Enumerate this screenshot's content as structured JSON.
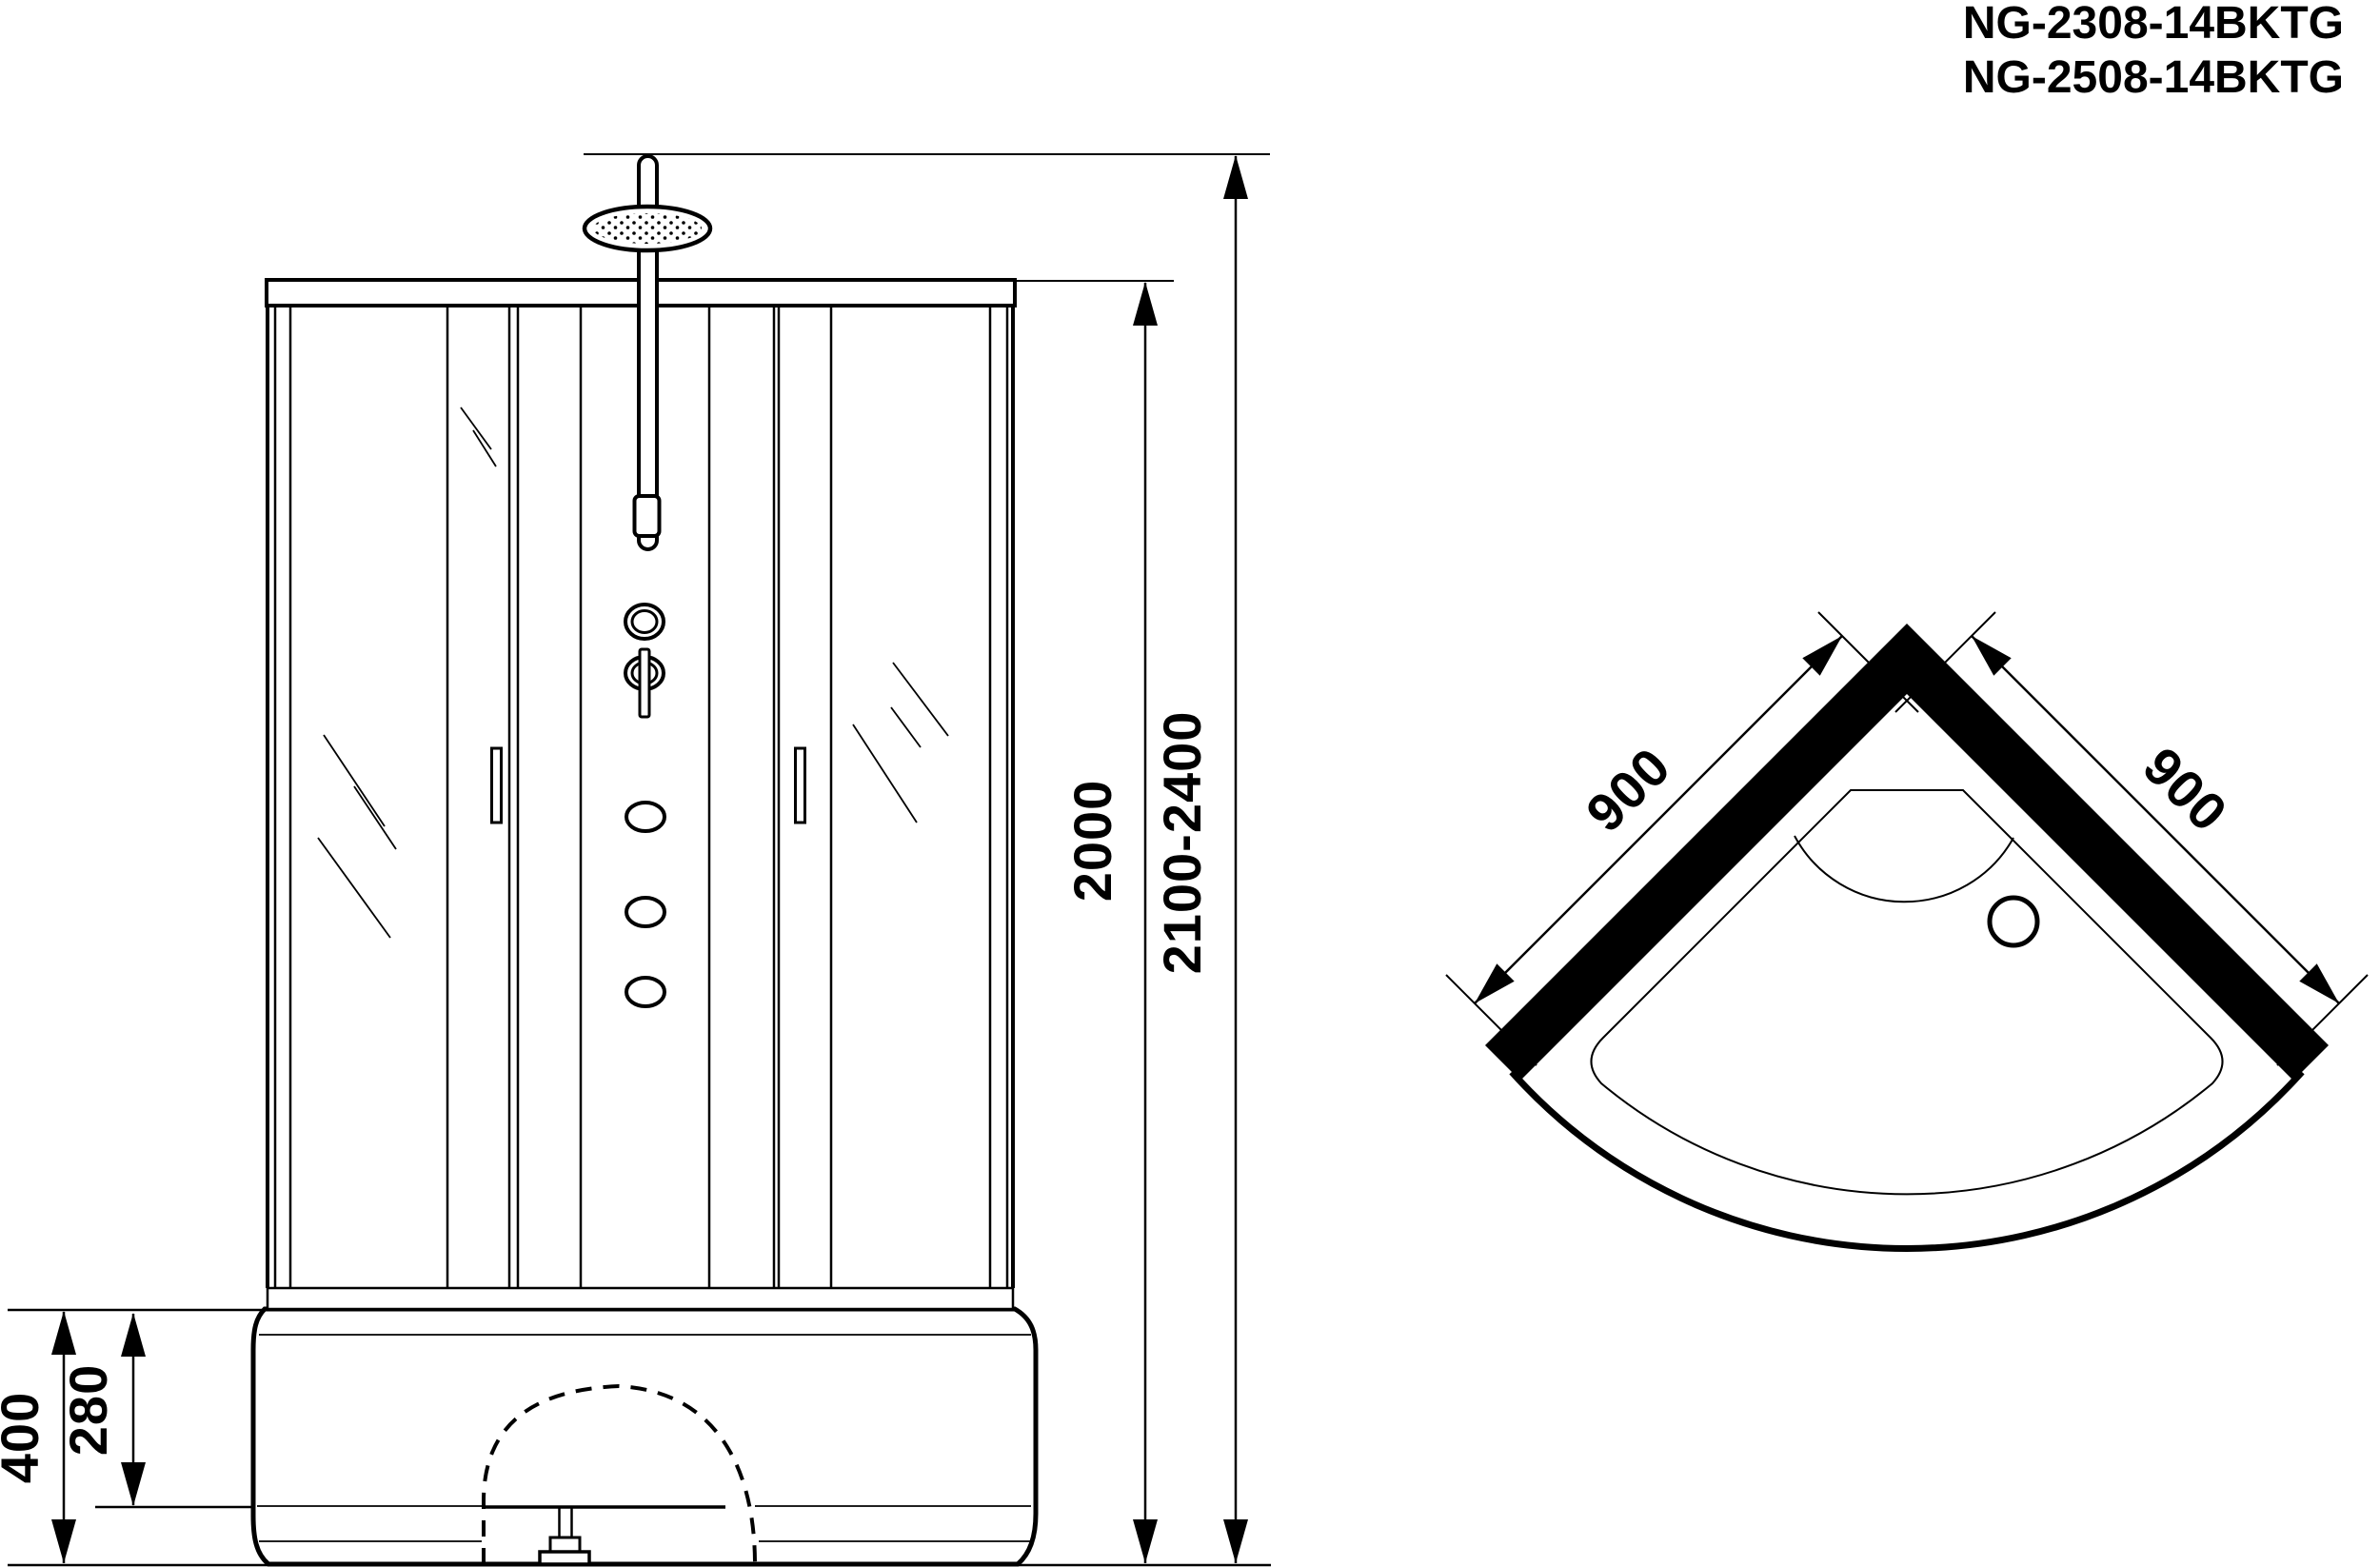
{
  "title": {
    "line1": "NG-2308-14BKTG",
    "line2": "NG-2508-14BKTG"
  },
  "front_view": {
    "dimensions": {
      "cabin_height": "2000",
      "total_height": "2100-2400",
      "tray_height": "400",
      "tray_depth": "280"
    }
  },
  "top_view": {
    "dimensions": {
      "left_side": "900",
      "right_side": "900"
    }
  },
  "colors": {
    "ink": "#000000",
    "paper": "#ffffff"
  }
}
